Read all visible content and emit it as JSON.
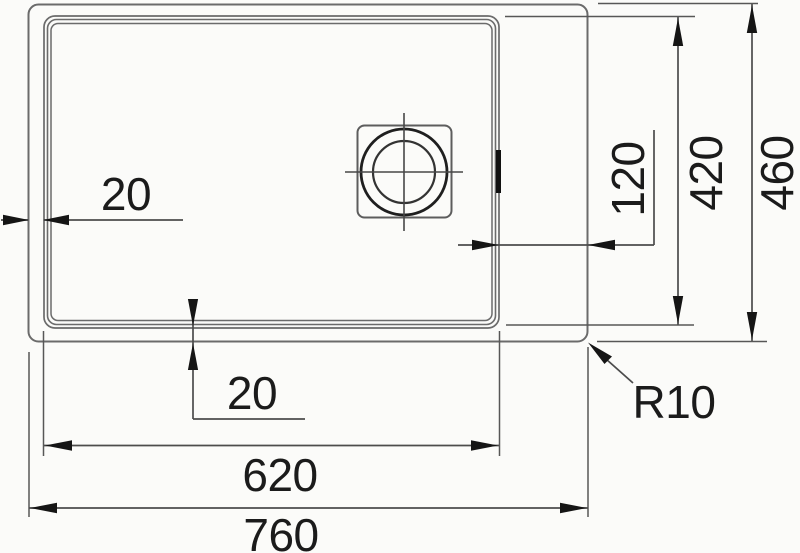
{
  "drawing": {
    "type": "technical-dimension-drawing",
    "subject": "kitchen sink top view with drain",
    "labels": {
      "rim_left": "20",
      "bowl_to_edge": "120",
      "bowl_height": "420",
      "overall_height": "460",
      "rim_bottom": "20",
      "bowl_width": "620",
      "overall_width": "760",
      "corner_radius": "R10"
    },
    "colors": {
      "background": "#fbfbf9",
      "outline": "#6b6b6b",
      "dimension_lines": "#4c4c4c",
      "arrows_text": "#151515"
    }
  }
}
